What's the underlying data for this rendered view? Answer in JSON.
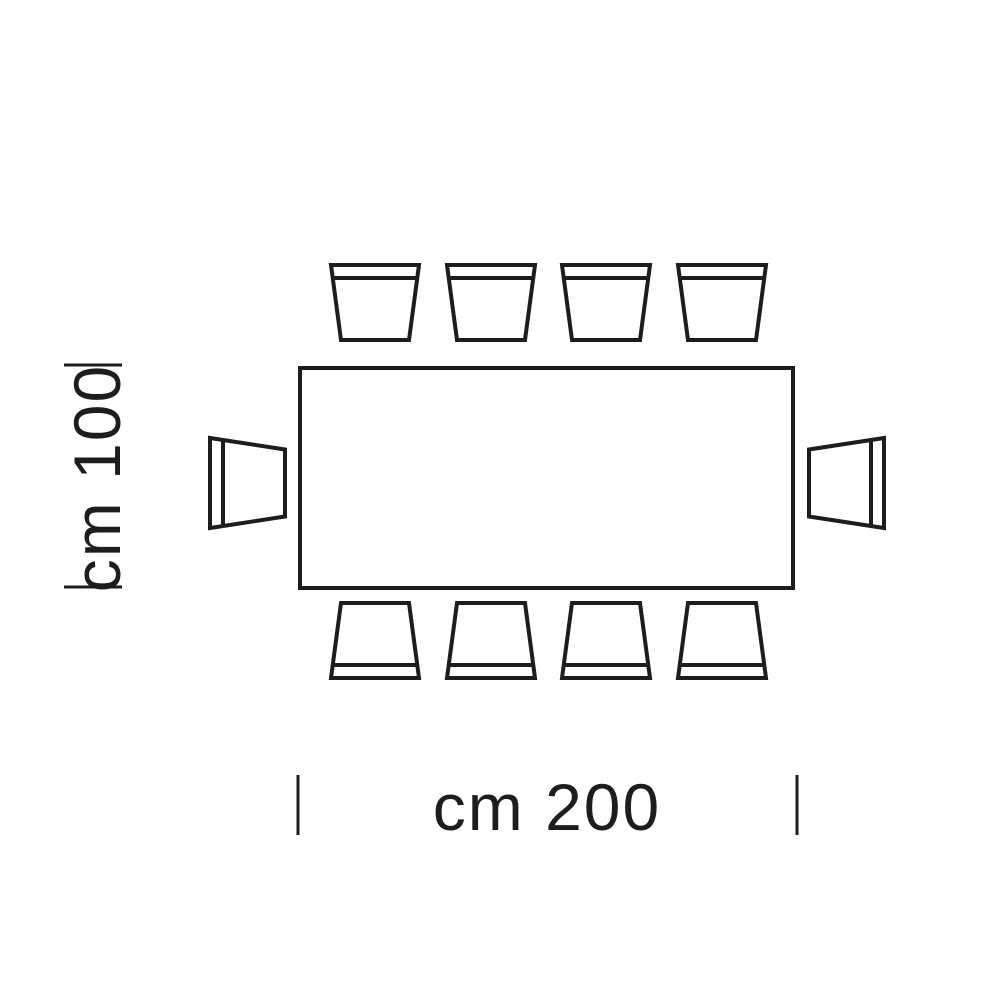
{
  "diagram": {
    "kind": "table-seating-plan-top-view",
    "colors": {
      "line": "#1d1d1b",
      "background": "#ffffff"
    },
    "labels": {
      "width": "cm 200",
      "depth": "cm 100"
    },
    "table": {
      "shape": "rectangle"
    },
    "chairs": {
      "top_count": 4,
      "bottom_count": 4,
      "left_count": 1,
      "right_count": 1,
      "total": 10
    }
  }
}
